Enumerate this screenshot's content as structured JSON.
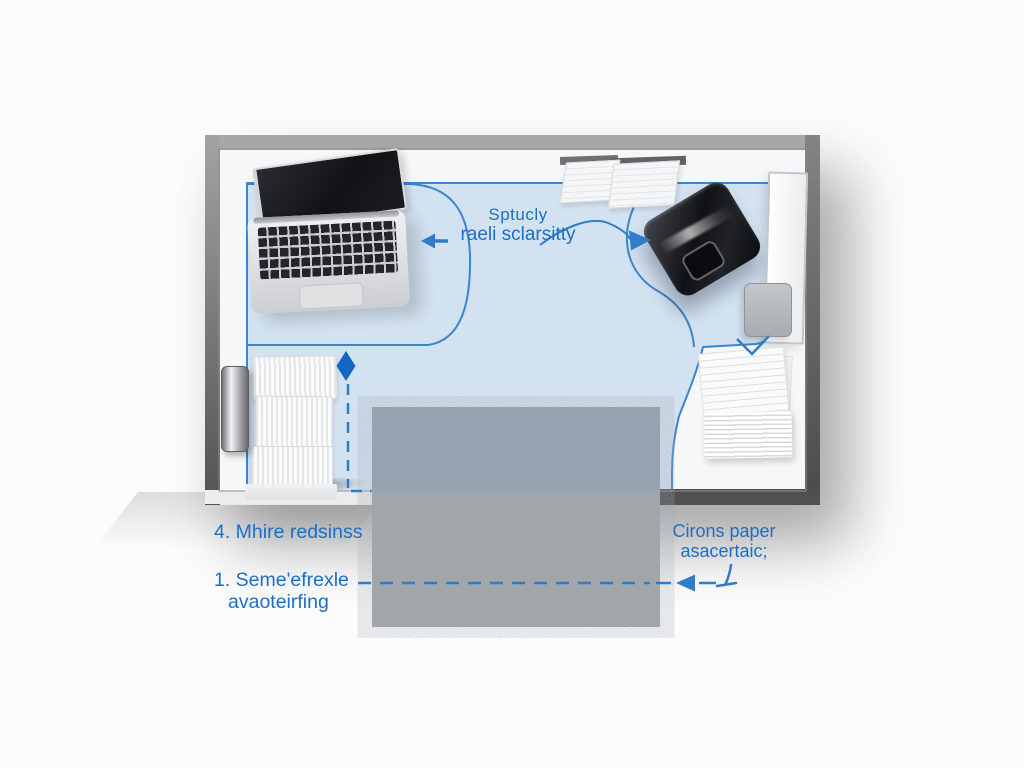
{
  "scene": {
    "type": "room-floor-plan-diagram",
    "background_color": "#fcfcfd",
    "colors": {
      "accent_blue_text": "#1c6fc4",
      "zone_fill": "#d3e2f1",
      "zone_stroke": "#3c85cc",
      "dash_blue": "#2f7cc8",
      "wall_light": "#a7a7a7",
      "wall_dark": "#505050",
      "rug_gray": "#a8abaf"
    },
    "annotations": {
      "center_label": {
        "line1": "Sptucly",
        "line2": "raeli sclarsitty"
      },
      "note_left_top": "4. Mhire redsinss",
      "note_left_bottom": {
        "line1": "1. Seme'efrexle",
        "line2": "avaoteirfing"
      },
      "note_right": {
        "line1": "Cirons paper",
        "line2": "asacertaic;"
      }
    },
    "objects": {
      "laptop": "laptop-top-view",
      "printer": "black-printer-top-view",
      "rug": "gray-textured-rug",
      "paper_sheets": "two-paper-sheets-top-wall",
      "door_panel": "white-door-panel-right-wall",
      "side_box": "gray-box-right-wall",
      "paper_stack": "paper-stack-bottom-right",
      "paper_trays": "stacked-paper-trays-left",
      "wall_handle": "chrome-wall-handle-left"
    },
    "markers": [
      "left-arrow",
      "right-arrow",
      "vertical-dimension-diamond",
      "vertical-dashed-line",
      "horizontal-dashed-line",
      "dashed-line-arrow",
      "tick-mark",
      "v-mark"
    ]
  }
}
